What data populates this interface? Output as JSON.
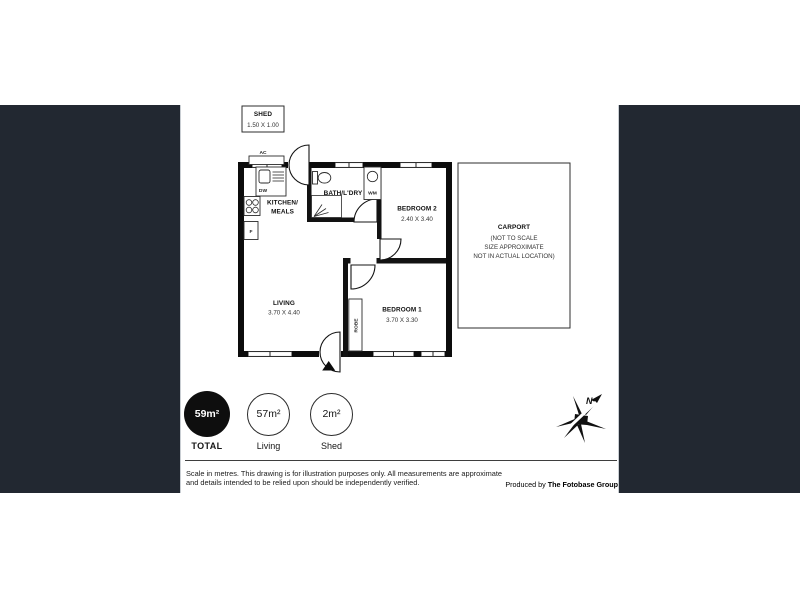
{
  "theme": {
    "panel_color": "#222831",
    "wall_color": "#0c0c0c",
    "paper_color": "#ffffff"
  },
  "floorplan": {
    "shed": {
      "name": "SHED",
      "dims": "1.50 X 1.00"
    },
    "rooms": {
      "kitchen": {
        "line1": "KITCHEN/",
        "line2": "MEALS"
      },
      "bath": {
        "name": "BATH/L'DRY"
      },
      "bedroom2": {
        "name": "BEDROOM 2",
        "dims": "2.40 X 3.40"
      },
      "bedroom1": {
        "name": "BEDROOM 1",
        "dims": "3.70 X 3.30"
      },
      "living": {
        "name": "LIVING",
        "dims": "3.70 X 4.40"
      },
      "carport": {
        "name": "CARPORT",
        "note1": "(NOT TO SCALE",
        "note2": "SIZE APPROXIMATE",
        "note3": "NOT IN ACTUAL LOCATION)"
      }
    },
    "fixtures": {
      "ac_label": "AC",
      "dw_label": "DW",
      "fridge_label": "F",
      "wm_label": "WM",
      "robe_label": "ROBE"
    }
  },
  "areas": {
    "total": {
      "value": "59m²",
      "label": "TOTAL"
    },
    "living": {
      "value": "57m²",
      "label": "Living"
    },
    "shed": {
      "value": "2m²",
      "label": "Shed"
    }
  },
  "footer": {
    "disclaimer": "Scale in metres. This drawing is for illustration purposes only. All measurements are approximate and details intended to be relied upon should be independently verified.",
    "produced_prefix": "Produced by ",
    "company": "The Fotobase Group"
  },
  "logo": {
    "letter": "N"
  }
}
